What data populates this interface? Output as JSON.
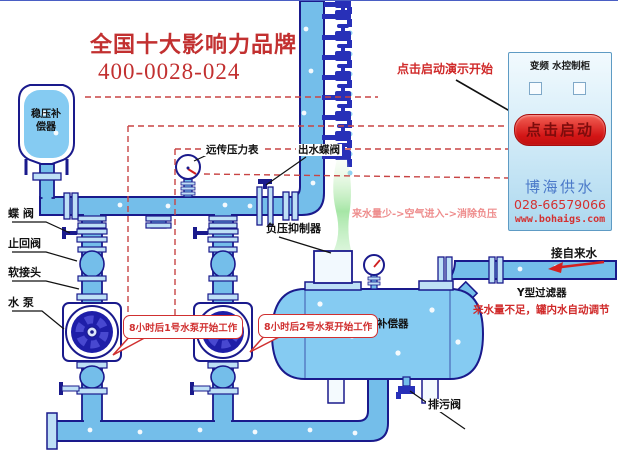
{
  "header": {
    "brand_title": "全国十大影响力品牌",
    "hotline": "400-0028-024"
  },
  "cabinet": {
    "panel_label": "变频  水控制柜",
    "start_button": "点击启动",
    "company": "博海供水",
    "phone": "028-66579066",
    "website": "www.bohaigs.com"
  },
  "callouts": {
    "demo_hint": "点击启动演示开始",
    "pump1": "8小时后1号水泵开始工作",
    "pump2": "8小时后2号水泵开始工作",
    "air_flow_note": "来水量少->空气进入->消除负压",
    "low_water_note": "来水量不足，罐内水自动调节"
  },
  "labels": {
    "stabilizer_tank": "稳压补偿器",
    "butterfly_valve": "蝶  阀",
    "check_valve": "止回阀",
    "soft_joint": "软接头",
    "water_pump": "水  泵",
    "remote_gauge": "远传压力表",
    "outlet_valve": "出水蝶阀",
    "suppressor": "负压抑制器",
    "compensator": "补偿器",
    "tap_water": "接自来水",
    "y_filter": "Y型过滤器",
    "drain_valve": "排污阀"
  },
  "colors": {
    "pipe": "#74BEEA",
    "pipe_outline": "#1A1A8C",
    "accent_red": "#D02A2A",
    "brand_blue": "#4B7AC9",
    "button_red": "#D31515",
    "gas_green": "#8FE08F",
    "wire_red": "#C84444"
  }
}
